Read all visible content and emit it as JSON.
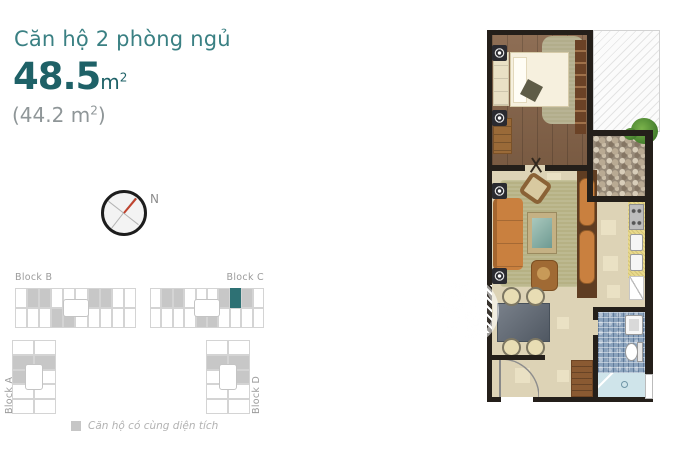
{
  "header": {
    "title": "Căn hộ 2 phòng ngủ",
    "area_value": "48.5",
    "area_unit": "m",
    "area_unit_exp": "2",
    "area_alt_prefix": "(44.2 m",
    "area_alt_sup": "2",
    "area_alt_suffix": ")"
  },
  "compass": {
    "label": "N"
  },
  "site_plan": {
    "blocks": [
      {
        "id": "b",
        "label": "Block B",
        "orientation": "horizontal",
        "rows": [
          "0110001100",
          "0001100000"
        ]
      },
      {
        "id": "c",
        "label": "Block C",
        "orientation": "horizontal",
        "rows": [
          "0110001210",
          "0000110000"
        ]
      },
      {
        "id": "a",
        "label": "Block A",
        "orientation": "vertical",
        "rows": [
          "01100",
          "01000"
        ]
      },
      {
        "id": "d",
        "label": "Block D",
        "orientation": "vertical",
        "rows": [
          "01000",
          "01100"
        ]
      }
    ],
    "legend": {
      "swatch_color": "#c6c6c6",
      "text": "Căn hộ có cùng diện tích"
    }
  },
  "colors": {
    "title_teal": "#3a8083",
    "area_teal": "#1e6167",
    "secondary_gray": "#8f9698",
    "block_label_gray": "#9b9b9b",
    "legend_gray": "#b2b2b2",
    "unit_highlight_teal": "#2e7174",
    "unit_shaded_gray": "#c7c7c7",
    "compass_needle_red": "#c0432e",
    "plan_wall": "#241f1a",
    "plan_wood_floor": "#87654a",
    "plan_tile_floor": "#ddd3b6",
    "plan_rug_olive": "#b6b184",
    "plan_sofa_orange": "#c9803f",
    "plan_bath_mosaic_blue": "#8aa2bc",
    "plan_shower_blue": "#cfe4ea",
    "plan_kitchen_counter_yellow": "#e8d98c"
  }
}
